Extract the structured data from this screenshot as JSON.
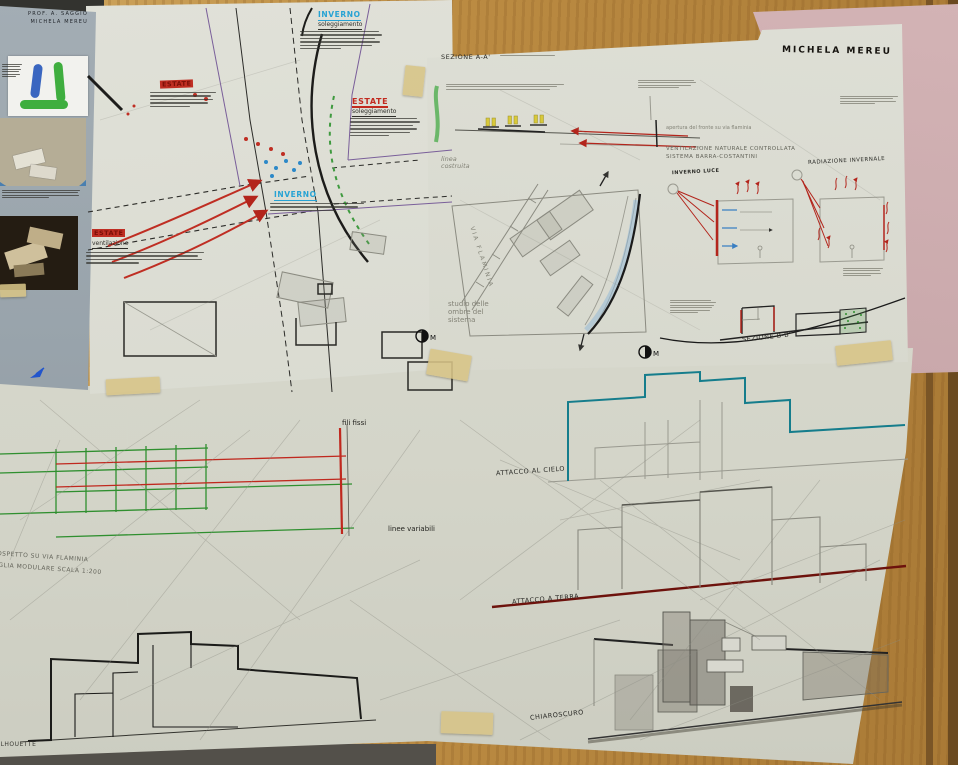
{
  "labels": {
    "author": "MICHELA MEREU",
    "estate_top": "ESTATE",
    "estate_mid": "ESTATE",
    "estate_mid_sub": "soleggiamento",
    "estate_bottom": "ESTATE",
    "estate_bottom_sub": "ventilazione",
    "inverno_top": "INVERNO",
    "inverno_top_sub": "soleggiamento",
    "inverno_mid": "INVERNO",
    "sezione_aa": "SEZIONE A-A'",
    "linea_costruita": "linea costruita",
    "via_flaminia": "VIA FLAMINIA",
    "studio_ombre": "studio delle ombre del sistema",
    "apertura_fronte": "apertura del fronte su via flaminia",
    "ventilazione_naturale": "VENTILAZIONE NATURALE CONTROLLATA",
    "sistema_barra": "SISTEMA BARRA-COSTANTINI",
    "radiazione_invernale": "RADIAZIONE INVERNALE",
    "inverno_luce": "INVERNO LUCE",
    "sezione_bb": "SEZIONE B-B'",
    "fili_fissi": "fili fissi",
    "linee_variabili": "linee variabili",
    "prospetto": "PROSPETTO SU VIA FLAMINIA",
    "maglia": "MAGLIA MODULARE SCALA 1:200",
    "attacco_cielo": "ATTACCO AL CIELO",
    "attacco_terra": "ATTACCO A TERRA",
    "chiaroscuro": "CHIAROSCURO",
    "silhouette": "SILHOUETTE"
  },
  "poster": {
    "credit_1": "PROF.  A.  SAGGIO",
    "credit_2": "MICHELA  MEREU"
  },
  "icons": {
    "north_mark": "M"
  },
  "colors": {
    "red_ink": "#bf2e23",
    "cyan_ink": "#27a3d4",
    "teal_outline": "#157d8c",
    "green_line": "#2f8f2f",
    "ground_red": "#6d120c",
    "pencil": "#8a8a7e",
    "paper": "#d9dacf",
    "wood": "#b9893f",
    "poster_bg": "#9aa5ad",
    "pink_sheet": "#c7a6a9",
    "tape": "#d7c486"
  }
}
